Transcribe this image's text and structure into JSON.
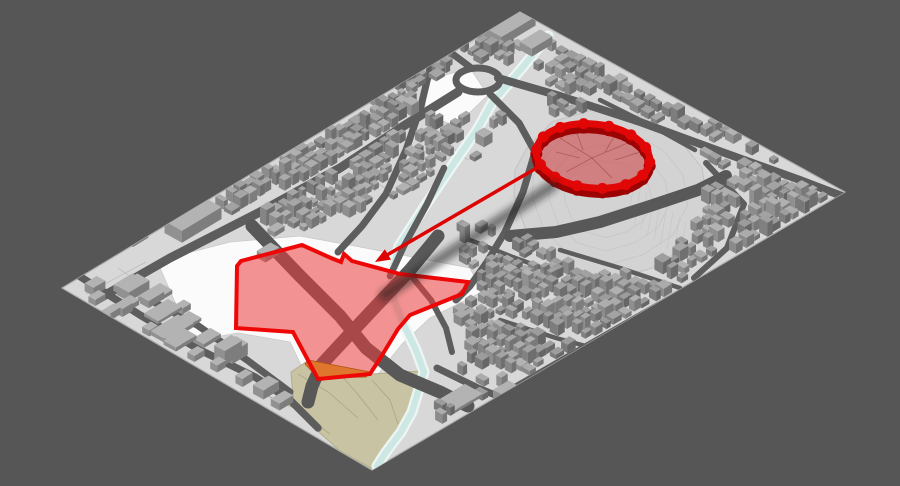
{
  "scene": {
    "background": "#565656",
    "ground": "#d8d8d8",
    "ground_edge": "#adadad",
    "road": "#5d5d5d",
    "road_major": "#585858",
    "river_water": "#cde8e4",
    "river_bank": "#eef6f3",
    "white_lot": "#fbfbfb",
    "park_fill": "#c8c4a3",
    "park_line": "#a9a584",
    "hill_fill": "#d3d3d3",
    "contour": "#c6c6c6",
    "orange_fill": "#e0762e",
    "orange_edge": "#a65616",
    "site_fill": "rgba(237,60,60,0.55)",
    "site_stroke": "#ee0707",
    "wall_top": "#e10707",
    "wall_side": "#9c0303",
    "citadel_fill": "rgba(205,45,45,0.5)",
    "facet_line": "rgba(120,20,20,0.35)",
    "arrow": "#dd0404",
    "arrow_shadow": "rgba(25,25,25,0.4)"
  },
  "viewport": {
    "width": 900,
    "height": 486
  },
  "ground_outline": [
    [
      520,
      12
    ],
    [
      845,
      192
    ],
    [
      372,
      470
    ],
    [
      62,
      288
    ]
  ],
  "annotations": {
    "citadel_highlight": {
      "center": [
        593,
        156
      ],
      "rx": 57,
      "ry": 32,
      "rotation_deg": 6,
      "bastion_count": 14,
      "facet_lines": [
        [
          [
            560,
            138
          ],
          [
            592,
            158
          ]
        ],
        [
          [
            592,
            158
          ],
          [
            630,
            142
          ]
        ],
        [
          [
            592,
            158
          ],
          [
            612,
            178
          ]
        ],
        [
          [
            592,
            158
          ],
          [
            566,
            172
          ]
        ],
        [
          [
            575,
            128
          ],
          [
            583,
            150
          ]
        ],
        [
          [
            618,
            130
          ],
          [
            605,
            152
          ]
        ],
        [
          [
            640,
            152
          ],
          [
            615,
            160
          ]
        ],
        [
          [
            556,
            152
          ],
          [
            580,
            158
          ]
        ]
      ]
    },
    "relocation_site_outline": [
      [
        237,
        266
      ],
      [
        241,
        261
      ],
      [
        302,
        245
      ],
      [
        331,
        258
      ],
      [
        341,
        262
      ],
      [
        344,
        254
      ],
      [
        352,
        261
      ],
      [
        400,
        274
      ],
      [
        468,
        282
      ],
      [
        462,
        294
      ],
      [
        410,
        315
      ],
      [
        398,
        329
      ],
      [
        381,
        357
      ],
      [
        370,
        374
      ],
      [
        318,
        379
      ],
      [
        293,
        332
      ],
      [
        236,
        328
      ]
    ],
    "sub_area_orange": [
      [
        308,
        360
      ],
      [
        370,
        372
      ],
      [
        366,
        377
      ],
      [
        318,
        378
      ],
      [
        305,
        364
      ]
    ],
    "relocation_arrow": {
      "from": [
        540,
        166
      ],
      "to": [
        375,
        262
      ],
      "shadow_from": [
        552,
        186
      ],
      "shadow_to": [
        385,
        295
      ]
    }
  },
  "terrain": {
    "hill_polygon": [
      [
        527,
        148
      ],
      [
        552,
        122
      ],
      [
        592,
        110
      ],
      [
        640,
        116
      ],
      [
        678,
        138
      ],
      [
        702,
        168
      ],
      [
        708,
        205
      ],
      [
        690,
        243
      ],
      [
        652,
        268
      ],
      [
        606,
        281
      ],
      [
        560,
        268
      ],
      [
        528,
        236
      ],
      [
        514,
        196
      ],
      [
        515,
        170
      ]
    ],
    "hill_center": [
      606,
      202
    ],
    "park_polygon": [
      [
        291,
        372
      ],
      [
        306,
        362
      ],
      [
        320,
        378
      ],
      [
        366,
        377
      ],
      [
        372,
        374
      ],
      [
        421,
        371
      ],
      [
        426,
        381
      ],
      [
        407,
        430
      ],
      [
        382,
        460
      ],
      [
        371,
        468
      ],
      [
        340,
        451
      ],
      [
        310,
        424
      ],
      [
        293,
        398
      ]
    ],
    "park_contours": [
      [
        [
          268,
          396
        ],
        [
          298,
          410
        ],
        [
          330,
          434
        ]
      ],
      [
        [
          298,
          374
        ],
        [
          328,
          392
        ],
        [
          358,
          418
        ]
      ],
      [
        [
          336,
          370
        ],
        [
          356,
          392
        ],
        [
          378,
          420
        ]
      ],
      [
        [
          372,
          380
        ],
        [
          390,
          400
        ],
        [
          398,
          424
        ]
      ]
    ],
    "canal_path": [
      [
        548,
        36
      ],
      [
        522,
        68
      ],
      [
        492,
        103
      ],
      [
        477,
        130
      ],
      [
        452,
        166
      ],
      [
        425,
        206
      ],
      [
        399,
        246
      ],
      [
        392,
        272
      ],
      [
        394,
        300
      ],
      [
        404,
        325
      ],
      [
        416,
        350
      ],
      [
        424,
        372
      ],
      [
        412,
        412
      ],
      [
        401,
        432
      ],
      [
        386,
        452
      ],
      [
        377,
        466
      ]
    ],
    "white_lots": [
      [
        [
          157,
          261
        ],
        [
          230,
          242
        ],
        [
          300,
          236
        ],
        [
          360,
          247
        ],
        [
          470,
          268
        ],
        [
          482,
          292
        ],
        [
          430,
          318
        ],
        [
          402,
          344
        ],
        [
          372,
          382
        ],
        [
          312,
          388
        ],
        [
          290,
          342
        ],
        [
          238,
          333
        ],
        [
          192,
          341
        ]
      ],
      [
        [
          428,
          80
        ],
        [
          470,
          68
        ],
        [
          488,
          95
        ],
        [
          456,
          126
        ],
        [
          424,
          114
        ]
      ]
    ],
    "parcel_lines": [
      [
        [
          86,
          294
        ],
        [
          146,
          262
        ]
      ],
      [
        [
          118,
          268
        ],
        [
          150,
          290
        ]
      ],
      [
        [
          320,
          190
        ],
        [
          356,
          214
        ]
      ],
      [
        [
          352,
          168
        ],
        [
          398,
          196
        ]
      ],
      [
        [
          300,
          298
        ],
        [
          330,
          322
        ]
      ],
      [
        [
          430,
          130
        ],
        [
          468,
          160
        ]
      ],
      [
        [
          250,
          250
        ],
        [
          282,
          270
        ]
      ]
    ]
  },
  "roads": [
    {
      "w": 9,
      "p": [
        [
          100,
          298
        ],
        [
          170,
          258
        ],
        [
          260,
          212
        ],
        [
          340,
          168
        ],
        [
          402,
          127
        ],
        [
          458,
          92
        ]
      ]
    },
    {
      "w": 8,
      "p": [
        [
          498,
          78
        ],
        [
          560,
          96
        ],
        [
          640,
          122
        ],
        [
          722,
          152
        ],
        [
          800,
          180
        ],
        [
          842,
          196
        ]
      ]
    },
    {
      "w": 7,
      "p": [
        [
          470,
          67
        ],
        [
          446,
          49
        ],
        [
          424,
          40
        ],
        [
          404,
          30
        ]
      ]
    },
    {
      "w": 7,
      "p": [
        [
          490,
          94
        ],
        [
          519,
          123
        ],
        [
          535,
          152
        ],
        [
          523,
          192
        ],
        [
          505,
          232
        ],
        [
          487,
          262
        ],
        [
          470,
          286
        ],
        [
          456,
          300
        ]
      ]
    },
    {
      "w": 7,
      "p": [
        [
          432,
          60
        ],
        [
          421,
          106
        ],
        [
          406,
          150
        ],
        [
          386,
          194
        ],
        [
          362,
          226
        ],
        [
          338,
          252
        ]
      ]
    },
    {
      "w": 6.5,
      "p": [
        [
          444,
          168
        ],
        [
          427,
          204
        ],
        [
          404,
          246
        ],
        [
          390,
          276
        ]
      ]
    },
    {
      "w": 13,
      "p": [
        [
          252,
          226
        ],
        [
          300,
          276
        ],
        [
          340,
          316
        ],
        [
          366,
          348
        ],
        [
          400,
          375
        ],
        [
          440,
          392
        ],
        [
          468,
          406
        ]
      ]
    },
    {
      "w": 13,
      "p": [
        [
          438,
          236
        ],
        [
          410,
          270
        ],
        [
          378,
          304
        ],
        [
          348,
          336
        ],
        [
          322,
          364
        ],
        [
          312,
          386
        ],
        [
          308,
          402
        ]
      ]
    },
    {
      "w": 6,
      "p": [
        [
          408,
          272
        ],
        [
          431,
          300
        ],
        [
          446,
          328
        ],
        [
          452,
          352
        ]
      ]
    },
    {
      "w": 7.5,
      "p": [
        [
          73,
          272
        ],
        [
          140,
          315
        ],
        [
          200,
          350
        ],
        [
          255,
          377
        ],
        [
          290,
          400
        ],
        [
          318,
          428
        ]
      ]
    },
    {
      "w": 7,
      "p": [
        [
          150,
          300
        ],
        [
          197,
          325
        ],
        [
          247,
          360
        ],
        [
          290,
          392
        ]
      ]
    },
    {
      "w": 7,
      "p": [
        [
          437,
          368
        ],
        [
          478,
          388
        ],
        [
          500,
          397
        ]
      ]
    },
    {
      "w": 7,
      "p": [
        [
          500,
          397
        ],
        [
          472,
          424
        ],
        [
          448,
          440
        ]
      ]
    },
    {
      "w": 5.5,
      "p": [
        [
          502,
          394
        ],
        [
          568,
          356
        ],
        [
          638,
          316
        ],
        [
          702,
          280
        ]
      ]
    },
    {
      "w": 6,
      "p": [
        [
          706,
          163
        ],
        [
          744,
          204
        ],
        [
          727,
          248
        ],
        [
          694,
          278
        ]
      ]
    },
    {
      "w": 12,
      "p": [
        [
          510,
          236
        ],
        [
          556,
          232
        ],
        [
          600,
          222
        ],
        [
          650,
          206
        ],
        [
          698,
          190
        ],
        [
          726,
          176
        ]
      ]
    },
    {
      "w": 4.5,
      "p": [
        [
          600,
          100
        ],
        [
          650,
          125
        ],
        [
          695,
          150
        ]
      ]
    },
    {
      "w": 4.5,
      "p": [
        [
          560,
          250
        ],
        [
          620,
          268
        ],
        [
          680,
          288
        ]
      ]
    },
    {
      "w": 4.5,
      "p": [
        [
          500,
          320
        ],
        [
          556,
          338
        ],
        [
          608,
          352
        ]
      ]
    },
    {
      "w": 4.5,
      "p": [
        [
          470,
          240
        ],
        [
          510,
          256
        ],
        [
          548,
          270
        ]
      ]
    }
  ],
  "roundabout": {
    "cx": 478,
    "cy": 80,
    "rx": 22,
    "ry": 12
  },
  "building_clusters": [
    {
      "poly": [
        [
          212,
          204
        ],
        [
          498,
          28
        ],
        [
          544,
          62
        ],
        [
          470,
          170
        ],
        [
          392,
          200
        ],
        [
          298,
          234
        ]
      ],
      "step": 10.5,
      "amin": 2.2,
      "amax": 5,
      "hmin": 4,
      "hmax": 12
    },
    {
      "poly": [
        [
          550,
          42
        ],
        [
          838,
          194
        ],
        [
          732,
          272
        ],
        [
          620,
          190
        ],
        [
          552,
          118
        ]
      ],
      "step": 11,
      "amin": 2.4,
      "amax": 5.2,
      "hmin": 4,
      "hmax": 12
    },
    {
      "poly": [
        [
          456,
          228
        ],
        [
          546,
          234
        ],
        [
          562,
          300
        ],
        [
          470,
          302
        ]
      ],
      "step": 10,
      "amin": 2.2,
      "amax": 4.6,
      "hmin": 4,
      "hmax": 11
    },
    {
      "poly": [
        [
          548,
          236
        ],
        [
          762,
          256
        ],
        [
          702,
          322
        ],
        [
          564,
          312
        ]
      ],
      "step": 11,
      "amin": 2.4,
      "amax": 5,
      "hmin": 4,
      "hmax": 12
    },
    {
      "poly": [
        [
          456,
          302
        ],
        [
          658,
          318
        ],
        [
          572,
          392
        ],
        [
          470,
          362
        ]
      ],
      "step": 11,
      "amin": 2.4,
      "amax": 5,
      "hmin": 4,
      "hmax": 12
    },
    {
      "poly": [
        [
          432,
          362
        ],
        [
          556,
          392
        ],
        [
          502,
          448
        ],
        [
          440,
          428
        ]
      ],
      "step": 12,
      "amin": 2.4,
      "amax": 5,
      "hmin": 4,
      "hmax": 10
    },
    {
      "poly": [
        [
          386,
          54
        ],
        [
          452,
          38
        ],
        [
          464,
          76
        ],
        [
          414,
          96
        ]
      ],
      "step": 11,
      "amin": 2.4,
      "amax": 5,
      "hmin": 4,
      "hmax": 10
    }
  ],
  "landmark_buildings": [
    [
      193,
      226,
      23,
      10,
      12
    ],
    [
      138,
      241,
      9,
      3,
      4
    ],
    [
      133,
      292,
      12,
      7,
      9
    ],
    [
      152,
      301,
      9,
      5,
      7
    ],
    [
      163,
      313,
      14,
      8,
      3
    ],
    [
      184,
      324,
      13,
      7,
      3
    ],
    [
      180,
      342,
      12,
      7,
      4
    ],
    [
      207,
      340,
      10,
      6,
      4
    ],
    [
      228,
      357,
      10,
      6,
      14
    ],
    [
      111,
      316,
      7,
      4,
      7
    ],
    [
      97,
      301,
      6,
      4,
      6
    ],
    [
      95,
      290,
      7,
      5,
      8
    ],
    [
      102,
      323,
      7,
      4,
      6
    ],
    [
      128,
      288,
      11,
      6,
      6
    ],
    [
      127,
      307,
      9,
      5,
      5
    ],
    [
      155,
      297,
      13,
      7,
      4
    ],
    [
      172,
      331,
      16,
      9,
      4
    ],
    [
      183,
      310,
      5,
      4,
      6
    ],
    [
      124,
      312,
      6,
      4,
      8
    ],
    [
      234,
      356,
      9,
      7,
      12
    ],
    [
      266,
      392,
      9,
      6,
      9
    ],
    [
      282,
      404,
      8,
      5,
      7
    ],
    [
      150,
      332,
      5,
      4,
      6
    ],
    [
      172,
      344,
      5,
      4,
      7
    ],
    [
      196,
      357,
      6,
      4,
      6
    ],
    [
      218,
      368,
      5,
      4,
      7
    ],
    [
      244,
      382,
      6,
      4,
      8
    ],
    [
      508,
      30,
      20,
      12,
      9
    ],
    [
      536,
      47,
      12,
      7,
      8
    ],
    [
      484,
      21,
      9,
      5,
      6
    ],
    [
      460,
      400,
      16,
      10,
      3
    ],
    [
      506,
      396,
      9,
      6,
      8
    ],
    [
      268,
      256,
      8,
      5,
      7
    ],
    [
      276,
      232,
      6,
      4,
      5
    ]
  ]
}
